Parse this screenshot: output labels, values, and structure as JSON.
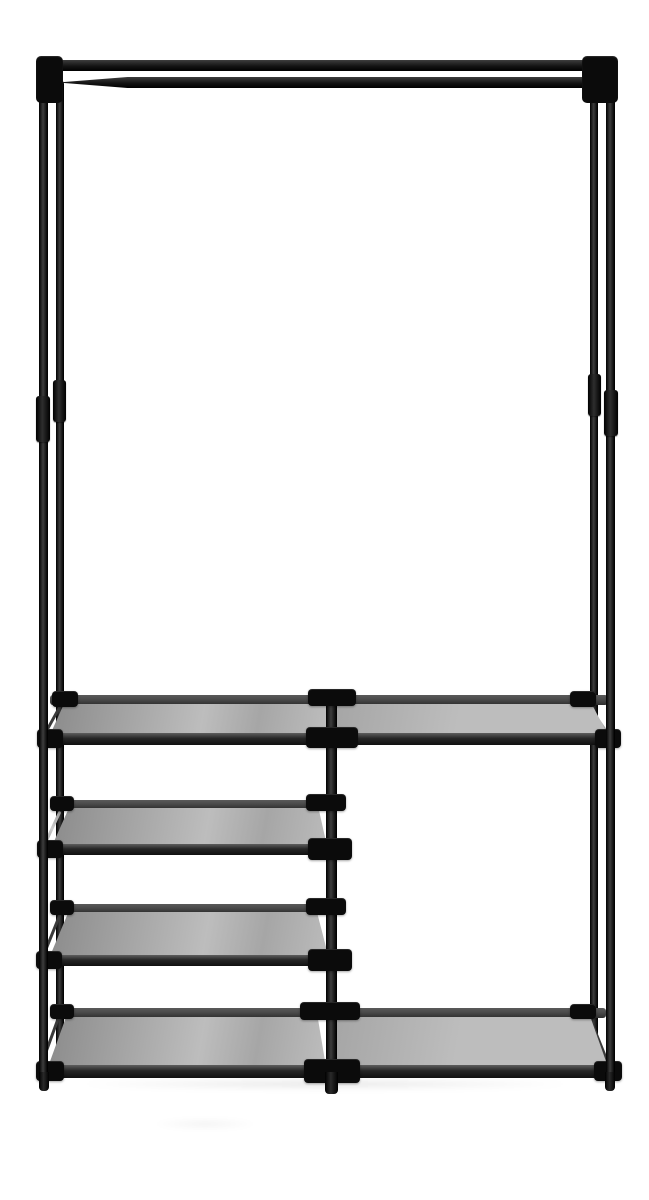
{
  "scene": {
    "type": "product-photo",
    "subject": "Black metal garment rack with top hanging rod and grey fabric shelves",
    "description": "Freestanding clothes rack on a plain white background: tall open hanging section at the top, a full-width fabric shelf at mid height, three stacked fabric shelves in the lower-left column, an open storage bay on the lower right, and a full-width fabric shelf at the bottom.",
    "background_color": "#ffffff"
  },
  "palette": {
    "bg": "#ffffff",
    "frame": "#141414",
    "frame_hi": "#3d3d3d",
    "connector": "#0b0b0b",
    "rail_back": "#4a4a4a",
    "rail_back_dark": "#2e2e2e",
    "rail_front_hi": "#5e5e5e",
    "rail_front": "#262626",
    "rail_front_dark": "#101010",
    "fabric_dark": "#8b8b8b",
    "fabric_mid": "#a6a6a6",
    "fabric_light": "#bdbdbd",
    "silver": "#b5b5b5",
    "silver_hi": "#efefef",
    "shine": "#cfcfcf",
    "shadow": "rgba(0,0,0,0.10)"
  },
  "parts": {
    "top_frame_bar": "top frame cross bar",
    "hanging_rod": "clothes hanging rod with tapered end",
    "legs": [
      "front-left leg",
      "back-left leg",
      "back-right leg",
      "front-right leg"
    ],
    "leg_couplers": "tube coupling sleeves at mid height",
    "center_post": "central support post",
    "connectors": "black plastic T-joint connectors",
    "shelves": [
      {
        "name": "mid full-width shelf",
        "span": "full width"
      },
      {
        "name": "left shelf 2",
        "span": "left column"
      },
      {
        "name": "left shelf 3",
        "span": "left column"
      },
      {
        "name": "bottom full-width shelf",
        "span": "full width"
      }
    ],
    "shelf_fabric": "grey non-woven fabric panels",
    "open_bay": "tall open bay on lower right"
  }
}
